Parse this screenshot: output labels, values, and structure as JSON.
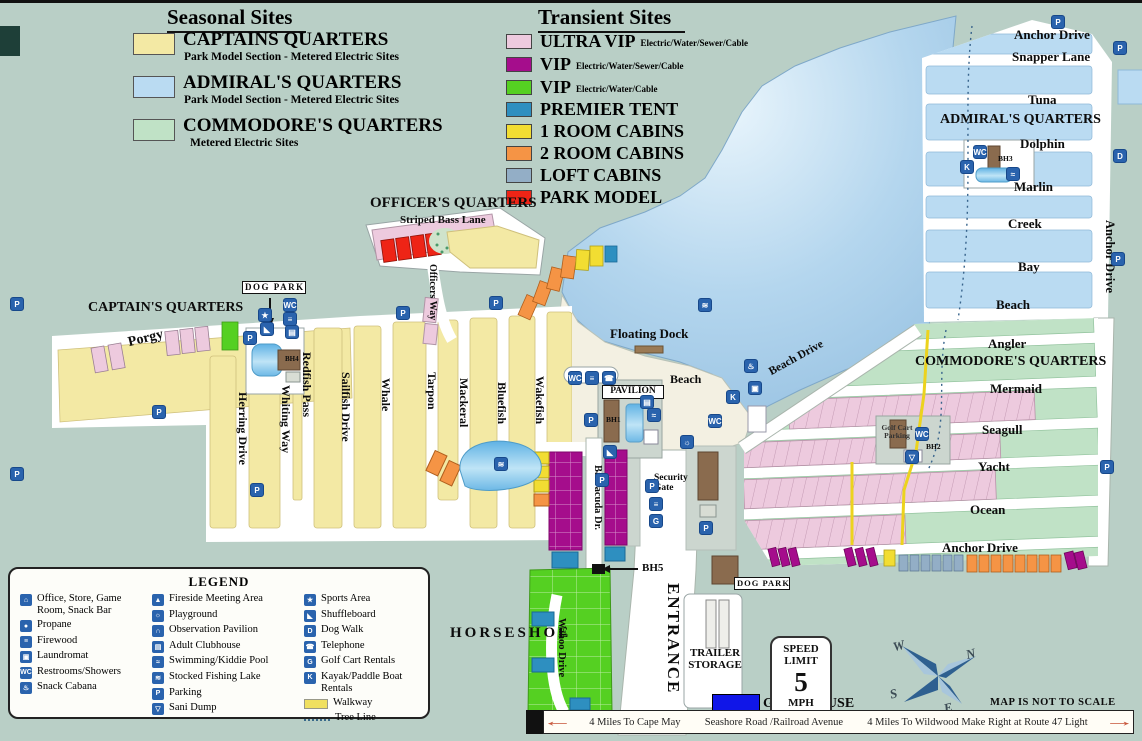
{
  "palette": {
    "background": "#b9cfc6",
    "water": "#a9cce8",
    "road": "#ffffff",
    "captains_yellow": "#f3e9a4",
    "admirals_blue": "#badbf2",
    "commodores_green": "#c0e2c6",
    "ultra_vip_pink": "#edcade",
    "vip_purple": "#a50d8c",
    "vip_green": "#55d022",
    "premier_tent_blue": "#2e8fc0",
    "one_room_cabin_yellow": "#f2dd32",
    "two_room_cabin_orange": "#f59445",
    "loft_cabin_slate": "#93aec6",
    "park_model_red": "#ee2416",
    "icon_blue": "#2a63ad",
    "gate_house_blue": "#1016e8",
    "walkway_yellow": "#f0d820"
  },
  "legend_seasonal": {
    "title": "Seasonal Sites",
    "items": [
      {
        "label": "CAPTAINS QUARTERS",
        "sub": "Park Model Section - Metered Electric Sites",
        "color": "#f3e9a4"
      },
      {
        "label": "ADMIRAL'S QUARTERS",
        "sub": "Park Model Section - Metered Electric Sites",
        "color": "#badbf2"
      },
      {
        "label": "COMMODORE'S QUARTERS",
        "sub": "Metered Electric Sites",
        "color": "#c0e2c6"
      }
    ]
  },
  "legend_transient": {
    "title": "Transient Sites",
    "items": [
      {
        "label": "ULTRA VIP",
        "sub": "Electric/Water/Sewer/Cable",
        "color": "#edcade"
      },
      {
        "label": "VIP",
        "sub": "Electric/Water/Sewer/Cable",
        "color": "#a50d8c"
      },
      {
        "label": "VIP",
        "sub": "Electric/Water/Cable",
        "color": "#55d022"
      },
      {
        "label": "PREMIER TENT",
        "sub": "",
        "color": "#2e8fc0"
      },
      {
        "label": "1 ROOM CABINS",
        "sub": "",
        "color": "#f2dd32"
      },
      {
        "label": "2 ROOM CABINS",
        "sub": "",
        "color": "#f59445"
      },
      {
        "label": "LOFT CABINS",
        "sub": "",
        "color": "#93aec6"
      },
      {
        "label": "PARK MODEL",
        "sub": "",
        "color": "#ee2416"
      }
    ]
  },
  "legend_box": {
    "title": "LEGEND",
    "col1": [
      {
        "glyph": "⌂",
        "label": "Office, Store, Game Room, Snack Bar"
      },
      {
        "glyph": "●",
        "label": "Propane"
      },
      {
        "glyph": "≡",
        "label": "Firewood"
      },
      {
        "glyph": "▣",
        "label": "Laundromat"
      },
      {
        "glyph": "WC",
        "label": "Restrooms/Showers"
      },
      {
        "glyph": "♨",
        "label": "Snack Cabana"
      }
    ],
    "col2": [
      {
        "glyph": "▲",
        "label": "Fireside Meeting Area"
      },
      {
        "glyph": "☼",
        "label": "Playground"
      },
      {
        "glyph": "∩",
        "label": "Observation Pavilion"
      },
      {
        "glyph": "▤",
        "label": "Adult Clubhouse"
      },
      {
        "glyph": "≈",
        "label": "Swimming/Kiddie Pool"
      },
      {
        "glyph": "≋",
        "label": "Stocked Fishing Lake"
      },
      {
        "glyph": "P",
        "label": "Parking"
      },
      {
        "glyph": "▽",
        "label": "Sani Dump"
      }
    ],
    "col3": [
      {
        "glyph": "★",
        "label": "Sports Area"
      },
      {
        "glyph": "◣",
        "label": "Shuffleboard"
      },
      {
        "glyph": "D",
        "label": "Dog Walk"
      },
      {
        "glyph": "☎",
        "label": "Telephone"
      },
      {
        "glyph": "G",
        "label": "Golf Cart Rentals"
      },
      {
        "glyph": "K",
        "label": "Kayak/Paddle Boat Rentals"
      }
    ],
    "walkway_label": "Walkway",
    "tree_line_label": "Tree Line"
  },
  "map": {
    "captains_quarters": "CAPTAIN'S QUARTERS",
    "officers_quarters": "OFFICER'S QUARTERS",
    "striped_bass_lane": "Striped Bass Lane",
    "officers_way": "Officers Way",
    "porgy": "Porgy",
    "herring_drive": "Herring Drive",
    "whiting_way": "Whiting Way",
    "redfish_pass": "Redfish Pass",
    "sailfish_drive": "Sailfish Drive",
    "whale": "Whale",
    "tarpon": "Tarpon",
    "mackeral": "Mackeral",
    "bluefish": "Bluefish",
    "wakefish": "Wakefish",
    "dog_park": "DOG PARK",
    "floating_dock": "Floating Dock",
    "beach": "Beach",
    "beach_drive": "Beach Drive",
    "pavilion": "PAVILION",
    "bh1": "BH1",
    "bh2": "BH2",
    "bh3": "BH3",
    "bh4": "BH4",
    "bh5": "BH5",
    "security_gate": "Security Gate",
    "admirals_quarters": "ADMIRAL'S QUARTERS",
    "anchor_drive": "Anchor Drive",
    "snapper_lane": "Snapper Lane",
    "tuna": "Tuna",
    "dolphin": "Dolphin",
    "marlin": "Marlin",
    "creek": "Creek",
    "bay": "Bay",
    "angler": "Angler",
    "commodores_quarters": "COMMODORE'S QUARTERS",
    "mermaid": "Mermaid",
    "seagull": "Seagull",
    "yacht": "Yacht",
    "ocean": "Ocean",
    "golf_cart_parking": "Golf Cart Parking",
    "horseshoe": "HORSESHOE",
    "barracuda_dr": "Barracuda Dr.",
    "wahoo_drive": "Wahoo Drive",
    "entrance": "ENTRANCE",
    "trailer_storage": "TRAILER STORAGE",
    "gate_house": "GATE HOUSE",
    "not_to_scale": "MAP IS NOT TO SCALE",
    "speed_sign": {
      "line1": "SPEED",
      "line2": "LIMIT",
      "value": "5",
      "line3": "MPH"
    },
    "compass": {
      "n": "N",
      "s": "S",
      "e": "E",
      "w": "W"
    },
    "bottom_bar": {
      "left_text": "4 Miles To Cape May",
      "center_text": "Seashore Road /Railroad Avenue",
      "right_text": "4 Miles To Wildwood Make Right at Route 47 Light"
    }
  },
  "icons": {
    "parking": "P",
    "restrooms": "WC",
    "firewood": "≡",
    "telephone": "☎",
    "snack_cabana": "♨",
    "laundromat": "▣",
    "adult_clubhouse": "▤",
    "swimming": "≈",
    "fishing": "≋",
    "playground": "☼",
    "kayak": "K",
    "dog_walk": "D",
    "golf_cart": "G",
    "sports": "★",
    "shuffleboard": "◣",
    "sani_dump": "▽",
    "arrow_left": "←",
    "arrow_right": "→"
  }
}
